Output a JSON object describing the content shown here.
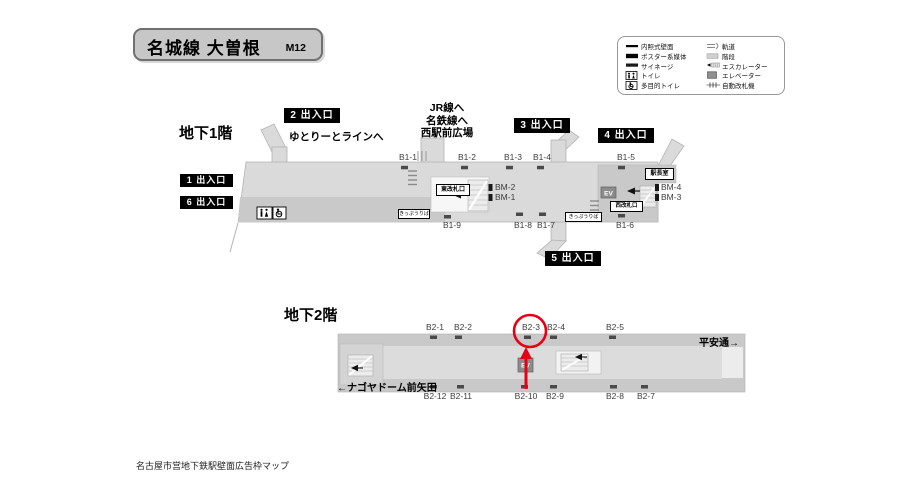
{
  "colors": {
    "highlight_red": "#e60012",
    "floor_light": "#dadada",
    "floor_dark": "#c9c9c9",
    "badge_black": "#000000"
  },
  "header": {
    "title": "名城線 大曽根",
    "code": "M12"
  },
  "legend": {
    "left": [
      "内照式壁面",
      "ポスター系媒体",
      "サイネージ",
      "トイレ",
      "多目的トイレ"
    ],
    "right": [
      "軌道",
      "階段",
      "エスカレーター",
      "エレベーター",
      "自動改札機"
    ]
  },
  "b1": {
    "floor_label": "地下1階",
    "exits": {
      "e1": "1 出入口",
      "e2": "2 出入口",
      "e3": "3 出入口",
      "e4": "4 出入口",
      "e5": "5 出入口",
      "e6": "6 出入口"
    },
    "yutorito": "ゆとりーとラインへ",
    "jr_lines": [
      "JR線へ",
      "名鉄線へ",
      "西駅前広場"
    ],
    "ads_top": [
      "B1-1",
      "B1-2",
      "B1-3",
      "B1-4",
      "B1-5"
    ],
    "ads_bottom": [
      "B1-9",
      "B1-8",
      "B1-7",
      "B1-6"
    ],
    "bm_east": [
      "BM-2",
      "BM-1"
    ],
    "bm_west": [
      "BM-4",
      "BM-3"
    ],
    "rooms": {
      "east_gate": "東改札口",
      "west_gate": "西改札口",
      "master_room": "駅長室",
      "ticket_east": "きっぷうりば",
      "ticket_west": "きっぷうりば",
      "ev": "EV"
    }
  },
  "b2": {
    "floor_label": "地下2階",
    "dir_left": "←ナゴヤドーム前矢田",
    "dir_right": "平安通→",
    "ads_top": [
      "B2-1",
      "B2-2",
      "B2-3",
      "B2-4",
      "B2-5"
    ],
    "ads_bottom": [
      "B2-12",
      "B2-11",
      "B2-10",
      "B2-9",
      "B2-8",
      "B2-7"
    ],
    "ev": "EV",
    "highlighted_position": "B2-3"
  },
  "footer": {
    "caption": "名古屋市営地下鉄駅壁面広告枠マップ"
  }
}
